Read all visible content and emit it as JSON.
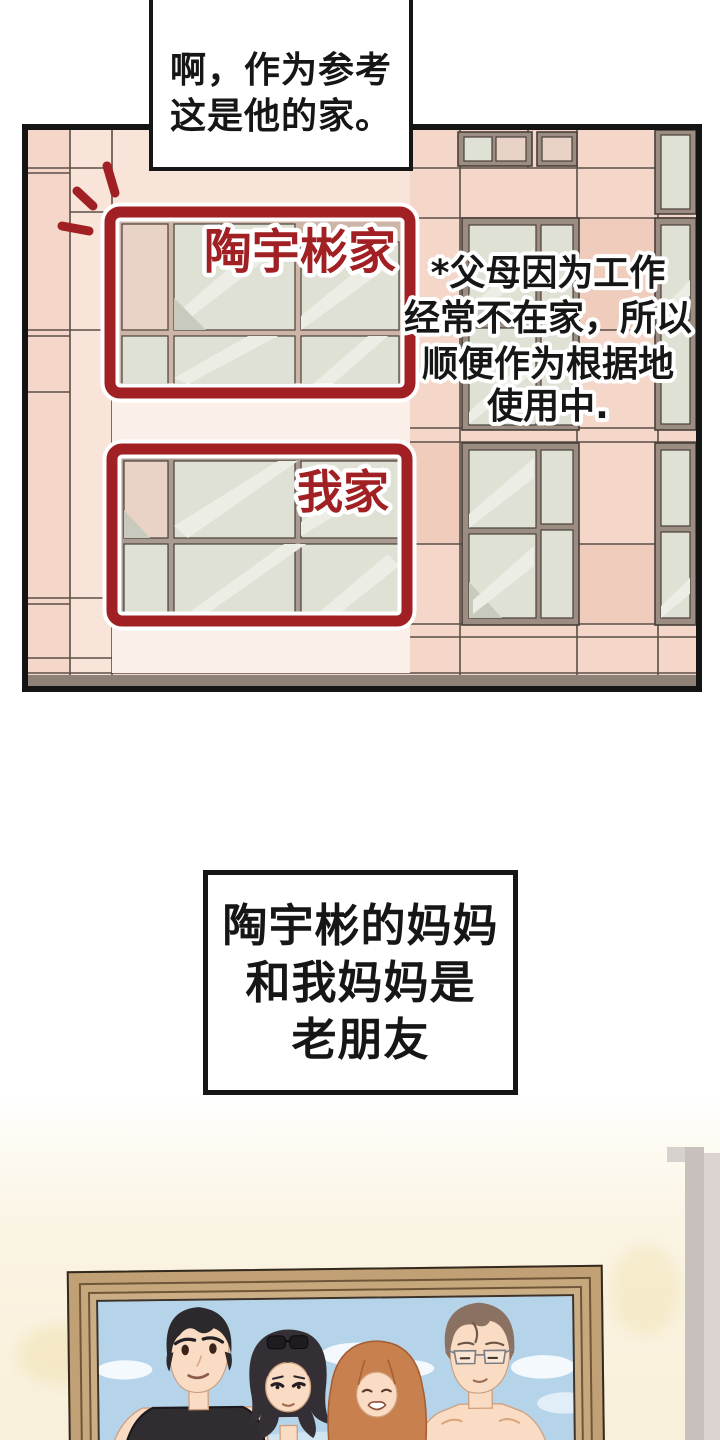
{
  "panels": {
    "building": {
      "caption": {
        "lines": [
          "啊，作为参考",
          "这是他的家。"
        ]
      },
      "labels": {
        "top_home": "陶宇彬家",
        "bottom_home": "我家"
      },
      "note": {
        "lines": [
          "*父母因为工作",
          "经常不在家，所以",
          "顺便作为根据地",
          "使用中."
        ]
      }
    },
    "narration": {
      "lines": [
        "陶宇彬的妈妈",
        "和我妈妈是",
        "老朋友"
      ]
    },
    "photo": {
      "people": [
        "black-haired-man",
        "bob-haired-woman-with-sunglasses",
        "long-auburn-haired-woman",
        "brown-haired-man-with-glasses"
      ]
    }
  },
  "colors": {
    "red": "#a12023",
    "ink": "#161616",
    "tile": "#f4d7c9",
    "tileLight": "#f8e4d9",
    "band": "#faf0e9",
    "glass": "#dfe1d5",
    "glassHi": "#eceee5",
    "glassLo": "#c7cabd",
    "winFrame": "#9c8d83",
    "winLine": "#49403a",
    "box1Frame": "#cdb5a7",
    "box2Frame": "#a99b91",
    "grid": "#5a4f47",
    "ledge": "#8e8177",
    "wall": "#f9f2de",
    "wood": "#c0a074",
    "woodLine": "#6f5638",
    "woodEdge": "#332a1f",
    "trimDark": "#c7c0bc",
    "trimLight": "#dbd4d0",
    "trimNotch": "#d8d2ce",
    "sky": "#b5d3e9",
    "cloud": "#f3f9fc",
    "skin": "#f9dcc3",
    "skinLine": "#cf9f7d",
    "hairBlack": "#2c292d",
    "hairBob": "#332f34",
    "hairAuburn": "#c8804f",
    "hairAuburnLine": "#a65f33",
    "hairBrown": "#8b7161",
    "topOrange": "#f1a83e",
    "topGreen": "#bcd67a",
    "tankBlack": "#2f2d30",
    "white": "#ffffff"
  }
}
